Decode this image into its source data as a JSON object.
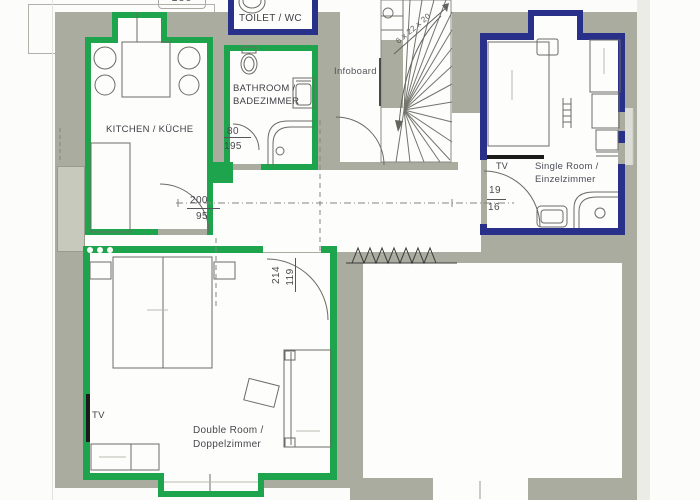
{
  "rooms": {
    "kitchen": {
      "label": "KITCHEN / KÜCHE"
    },
    "toilet": {
      "label": "TOILET / WC"
    },
    "bathroom": {
      "line1": "BATHROOM /",
      "line2": "BADEZIMMER"
    },
    "single": {
      "line1": "Single Room /",
      "line2": "Einzelzimmer",
      "tv": "TV"
    },
    "double": {
      "line1": "Double Room /",
      "line2": "Doppelzimmer",
      "tv": "TV"
    }
  },
  "annotations": {
    "infoboard": "Infoboard",
    "stair_note": "6 x 22 x 20",
    "edge_dim": "185"
  },
  "dims": {
    "bath_door_top": "80",
    "bath_door_bottom": "195",
    "kitchen_door_top": "200",
    "kitchen_door_bottom": "95",
    "single_door_top": "19",
    "single_door_bottom": "16",
    "double_door_a": "214",
    "double_door_b": "119"
  },
  "colors": {
    "wall": "#a9ac9e",
    "highlight_green": "#1ea44c",
    "highlight_blue": "#28308a"
  }
}
